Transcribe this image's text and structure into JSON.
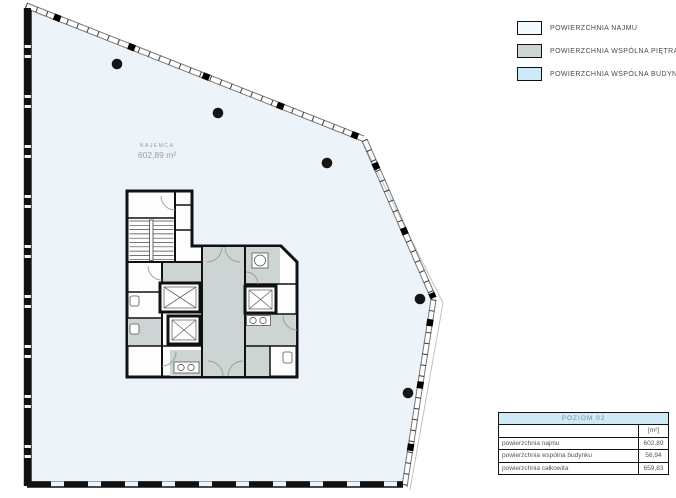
{
  "legend": {
    "items": [
      {
        "label": "POWIERZCHNIA NAJMU",
        "color": "#f3fafd"
      },
      {
        "label": "POWIERZCHNIA WSPÓLNA PIĘTRA",
        "color": "#ccd5d3"
      },
      {
        "label": "POWIERZCHNIA WSPÓLNA BUDYNKU",
        "color": "#cdeaf6"
      }
    ]
  },
  "plan": {
    "tenant_label": "NAJEMCA",
    "tenant_area": "602,89 m²"
  },
  "table": {
    "title": "POZIOM 02",
    "unit_header": "[m²]",
    "rows": [
      {
        "label": "powierzchnia najmu",
        "value": "602,89"
      },
      {
        "label": "powierzchnia wspólna budynku",
        "value": "56,94"
      },
      {
        "label": "powierzchnia całkowita",
        "value": "659,83"
      }
    ]
  },
  "colors": {
    "najmu": "#f3fafd",
    "wspolna_pietra": "#ccd5d3",
    "wspolna_budynku": "#cdeaf6",
    "floor_fill": "#edf4f9",
    "wall": "#111111"
  }
}
